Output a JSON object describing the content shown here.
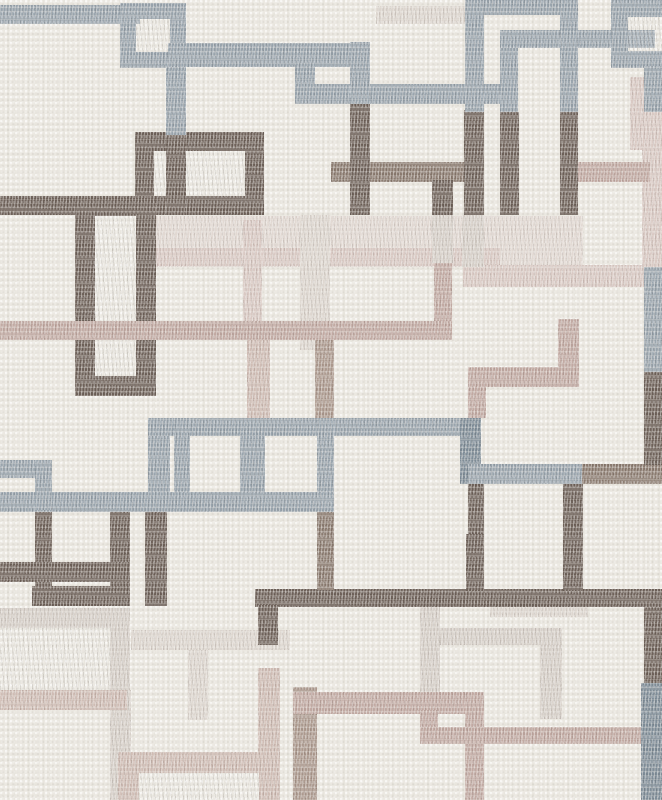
{
  "meta": {
    "kind": "wallpaper-pattern-swatch",
    "description": "Cream woven-texture wallpaper with overlapping stitched square outlines in slate blue-gray, dark brown, taupe, mauve pink and pale greige",
    "width": 662,
    "height": 800
  },
  "palette": {
    "background": "#ebe8e1",
    "slate": "#98a3ac",
    "slate_dark": "#7e8c97",
    "brown": "#6e6159",
    "taupe": "#8a7a6f",
    "taupe_light": "#ab988d",
    "mauve": "#c1a9a2",
    "pink_light": "#cfbcb4",
    "pale_pink": "#d9c9c3",
    "greige": "#d6cfc8",
    "greige_light": "#ddd6cf",
    "wash": "#e1d8d2"
  },
  "shapes": [
    {
      "n": "band-top-left",
      "k": "bar",
      "x": 0,
      "y": 5,
      "w": 140,
      "h": 19,
      "c": "slate",
      "z": 60
    },
    {
      "n": "square-top-left",
      "k": "frame",
      "x": 120,
      "y": 3,
      "w": 66,
      "h": 65,
      "b": 16,
      "c": "slate",
      "z": 60
    },
    {
      "n": "band-y48",
      "k": "bar",
      "x": 168,
      "y": 43,
      "w": 202,
      "h": 24,
      "c": "slate",
      "z": 60
    },
    {
      "n": "vert-x166",
      "k": "bar",
      "x": 166,
      "y": 67,
      "w": 20,
      "h": 68,
      "c": "slate",
      "z": 60
    },
    {
      "n": "vert-x295",
      "k": "bar",
      "x": 295,
      "y": 63,
      "w": 20,
      "h": 41,
      "c": "slate",
      "z": 60
    },
    {
      "n": "band-y84",
      "k": "bar",
      "x": 295,
      "y": 84,
      "w": 207,
      "h": 20,
      "c": "slate",
      "z": 60
    },
    {
      "n": "vert-x350-top",
      "k": "bar",
      "x": 350,
      "y": 42,
      "w": 20,
      "h": 62,
      "c": "slate",
      "z": 60
    },
    {
      "n": "band-top-center",
      "k": "bar",
      "x": 465,
      "y": 0,
      "w": 113,
      "h": 15,
      "c": "slate",
      "z": 60
    },
    {
      "n": "vert-x465-top",
      "k": "bar",
      "x": 465,
      "y": 0,
      "w": 19,
      "h": 112,
      "c": "slate",
      "z": 60
    },
    {
      "n": "band-y30",
      "k": "bar",
      "x": 500,
      "y": 30,
      "w": 155,
      "h": 18,
      "c": "slate",
      "z": 60
    },
    {
      "n": "vert-x500-top",
      "k": "bar",
      "x": 500,
      "y": 48,
      "w": 18,
      "h": 64,
      "c": "slate",
      "z": 60
    },
    {
      "n": "vert-x560-top",
      "k": "bar",
      "x": 560,
      "y": 15,
      "w": 18,
      "h": 97,
      "c": "slate",
      "z": 60
    },
    {
      "n": "square-top-right",
      "k": "frame",
      "x": 611,
      "y": 0,
      "w": 80,
      "h": 68,
      "b": 17,
      "c": "slate",
      "z": 60
    },
    {
      "n": "vert-right-upper",
      "k": "bar",
      "x": 644,
      "y": 66,
      "w": 18,
      "h": 46,
      "c": "slate",
      "z": 60
    },
    {
      "n": "band-y418",
      "k": "bar",
      "x": 148,
      "y": 418,
      "w": 333,
      "h": 18,
      "c": "slate",
      "z": 60
    },
    {
      "n": "vert-x148",
      "k": "bar",
      "x": 148,
      "y": 436,
      "w": 22,
      "h": 76,
      "c": "slate",
      "z": 60
    },
    {
      "n": "vert-x174",
      "k": "bar",
      "x": 174,
      "y": 418,
      "w": 16,
      "h": 75,
      "c": "slate",
      "z": 60
    },
    {
      "n": "vert-x240",
      "k": "bar",
      "x": 240,
      "y": 436,
      "w": 25,
      "h": 57,
      "c": "slate",
      "z": 60
    },
    {
      "n": "vert-x317-slate",
      "k": "bar",
      "x": 317,
      "y": 418,
      "w": 17,
      "h": 75,
      "c": "slate",
      "z": 60
    },
    {
      "n": "band-y493",
      "k": "bar",
      "x": 0,
      "y": 492,
      "w": 334,
      "h": 20,
      "c": "slate",
      "z": 60
    },
    {
      "n": "band-left-y460",
      "k": "bar",
      "x": 0,
      "y": 460,
      "w": 52,
      "h": 18,
      "c": "slate",
      "z": 60
    },
    {
      "n": "vert-x35-slate",
      "k": "bar",
      "x": 35,
      "y": 460,
      "w": 17,
      "h": 50,
      "c": "slate",
      "z": 60
    },
    {
      "n": "vert-x460-dark",
      "k": "bar",
      "x": 460,
      "y": 418,
      "w": 21,
      "h": 66,
      "c": "slate_dark",
      "z": 60
    },
    {
      "n": "band-y464",
      "k": "bar",
      "x": 468,
      "y": 464,
      "w": 114,
      "h": 20,
      "c": "slate",
      "z": 60
    },
    {
      "n": "band-y464-right",
      "k": "bar",
      "x": 582,
      "y": 464,
      "w": 80,
      "h": 20,
      "c": "taupe",
      "z": 45
    },
    {
      "n": "vert-right-mid-slate",
      "k": "bar",
      "x": 644,
      "y": 267,
      "w": 18,
      "h": 105,
      "c": "slate",
      "z": 60
    },
    {
      "n": "vert-right-bottom-slate",
      "k": "bar",
      "x": 641,
      "y": 683,
      "w": 21,
      "h": 117,
      "c": "slate_dark",
      "z": 60
    },
    {
      "n": "frame-b1",
      "k": "frame",
      "x": 135,
      "y": 132,
      "w": 129,
      "h": 83,
      "b": 19,
      "c": "brown",
      "z": 50
    },
    {
      "n": "vert-b1-inner",
      "k": "bar",
      "x": 166,
      "y": 135,
      "w": 20,
      "h": 80,
      "c": "brown",
      "z": 50
    },
    {
      "n": "band-y196-left",
      "k": "bar",
      "x": 0,
      "y": 196,
      "w": 140,
      "h": 19,
      "c": "brown",
      "z": 50
    },
    {
      "n": "frame-tall-left",
      "k": "frame",
      "x": 75,
      "y": 196,
      "w": 81,
      "h": 200,
      "b": 20,
      "c": "brown",
      "z": 50
    },
    {
      "n": "vert-x350-brown",
      "k": "bar",
      "x": 350,
      "y": 104,
      "w": 20,
      "h": 111,
      "c": "brown",
      "z": 50
    },
    {
      "n": "vert-x432-brown",
      "k": "bar",
      "x": 432,
      "y": 180,
      "w": 21,
      "h": 35,
      "c": "brown",
      "z": 50
    },
    {
      "n": "vert-x464-brown",
      "k": "bar",
      "x": 464,
      "y": 110,
      "w": 20,
      "h": 105,
      "c": "brown",
      "z": 50
    },
    {
      "n": "vert-x500-brown",
      "k": "bar",
      "x": 500,
      "y": 112,
      "w": 19,
      "h": 103,
      "c": "brown",
      "z": 50
    },
    {
      "n": "vert-x560-brown",
      "k": "bar",
      "x": 560,
      "y": 112,
      "w": 18,
      "h": 103,
      "c": "brown",
      "z": 50
    },
    {
      "n": "vert-right-brown-mid",
      "k": "bar",
      "x": 644,
      "y": 372,
      "w": 18,
      "h": 93,
      "c": "brown",
      "z": 50
    },
    {
      "n": "vert-x35-brown",
      "k": "bar",
      "x": 35,
      "y": 510,
      "w": 17,
      "h": 96,
      "c": "brown",
      "z": 50
    },
    {
      "n": "vert-x110-brown",
      "k": "bar",
      "x": 110,
      "y": 510,
      "w": 20,
      "h": 96,
      "c": "brown",
      "z": 50
    },
    {
      "n": "band-y562",
      "k": "bar",
      "x": 0,
      "y": 562,
      "w": 130,
      "h": 20,
      "c": "brown",
      "z": 50
    },
    {
      "n": "band-y586",
      "k": "bar",
      "x": 32,
      "y": 586,
      "w": 98,
      "h": 20,
      "c": "brown",
      "z": 50
    },
    {
      "n": "vert-x145-brown",
      "k": "bar",
      "x": 145,
      "y": 510,
      "w": 22,
      "h": 96,
      "c": "brown",
      "z": 50
    },
    {
      "n": "band-y589",
      "k": "bar",
      "x": 255,
      "y": 589,
      "w": 407,
      "h": 18,
      "c": "brown",
      "z": 50
    },
    {
      "n": "vert-x258-brown",
      "k": "bar",
      "x": 258,
      "y": 605,
      "w": 20,
      "h": 40,
      "c": "brown",
      "z": 50
    },
    {
      "n": "vert-x466-brown2",
      "k": "bar",
      "x": 466,
      "y": 534,
      "w": 18,
      "h": 57,
      "c": "brown",
      "z": 50
    },
    {
      "n": "vert-x563-brown2",
      "k": "bar",
      "x": 563,
      "y": 534,
      "w": 20,
      "h": 57,
      "c": "brown",
      "z": 50
    },
    {
      "n": "vert-x317-taupe",
      "k": "bar",
      "x": 317,
      "y": 510,
      "w": 17,
      "h": 80,
      "c": "taupe",
      "z": 50
    },
    {
      "n": "vert-right-brown-low",
      "k": "bar",
      "x": 644,
      "y": 607,
      "w": 18,
      "h": 76,
      "c": "brown",
      "z": 50
    },
    {
      "n": "vert-x468-brown3",
      "k": "bar",
      "x": 468,
      "y": 484,
      "w": 16,
      "h": 50,
      "c": "brown",
      "z": 50
    },
    {
      "n": "vert-x563-brown3",
      "k": "bar",
      "x": 563,
      "y": 484,
      "w": 20,
      "h": 50,
      "c": "brown",
      "z": 50
    },
    {
      "n": "band-y162",
      "k": "bar",
      "x": 331,
      "y": 162,
      "w": 135,
      "h": 20,
      "c": "taupe",
      "z": 45
    },
    {
      "n": "band-y162-right",
      "k": "bar",
      "x": 578,
      "y": 162,
      "w": 72,
      "h": 20,
      "c": "mauve",
      "z": 45
    },
    {
      "n": "band-pink-y321",
      "k": "bar",
      "x": 0,
      "y": 321,
      "w": 452,
      "h": 19,
      "c": "mauve",
      "z": 55
    },
    {
      "n": "vert-x434-mauve",
      "k": "bar",
      "x": 434,
      "y": 263,
      "w": 18,
      "h": 58,
      "c": "mauve",
      "z": 40
    },
    {
      "n": "vert-x432-greige",
      "k": "bar",
      "x": 432,
      "y": 215,
      "w": 21,
      "h": 48,
      "c": "greige",
      "z": 20
    },
    {
      "n": "vert-x462-greige",
      "k": "bar",
      "x": 462,
      "y": 215,
      "w": 22,
      "h": 52,
      "c": "greige",
      "z": 20
    },
    {
      "n": "vert-x558-mauve",
      "k": "bar",
      "x": 558,
      "y": 319,
      "w": 21,
      "h": 51,
      "c": "mauve",
      "z": 40
    },
    {
      "n": "band-y367",
      "k": "bar",
      "x": 468,
      "y": 367,
      "w": 111,
      "h": 20,
      "c": "mauve",
      "z": 40
    },
    {
      "n": "vert-x468-mauve",
      "k": "bar",
      "x": 468,
      "y": 387,
      "w": 18,
      "h": 31,
      "c": "mauve",
      "z": 40
    },
    {
      "n": "vert-x247-pink",
      "k": "bar",
      "x": 247,
      "y": 339,
      "w": 23,
      "h": 79,
      "c": "pink_light",
      "z": 40
    },
    {
      "n": "vert-x315-taupe2",
      "k": "bar",
      "x": 315,
      "y": 339,
      "w": 19,
      "h": 79,
      "c": "taupe_light",
      "z": 40
    },
    {
      "n": "vert-x243-palepink",
      "k": "bar",
      "x": 243,
      "y": 220,
      "w": 19,
      "h": 119,
      "c": "pale_pink",
      "z": 19
    },
    {
      "n": "vert-x300-greige",
      "k": "bar",
      "x": 300,
      "y": 215,
      "w": 30,
      "h": 135,
      "c": "greige_light",
      "z": 19
    },
    {
      "n": "band-y692",
      "k": "bar",
      "x": 293,
      "y": 692,
      "w": 191,
      "h": 22,
      "c": "mauve",
      "z": 40
    },
    {
      "n": "band-y690-left",
      "k": "bar",
      "x": 0,
      "y": 690,
      "w": 127,
      "h": 20,
      "c": "pink_light",
      "z": 40
    },
    {
      "n": "vert-x465-mauve2",
      "k": "bar",
      "x": 465,
      "y": 692,
      "w": 19,
      "h": 108,
      "c": "mauve",
      "z": 40
    },
    {
      "n": "vert-x420-mauve",
      "k": "bar",
      "x": 420,
      "y": 710,
      "w": 18,
      "h": 34,
      "c": "mauve",
      "z": 40
    },
    {
      "n": "band-y727",
      "k": "bar",
      "x": 420,
      "y": 727,
      "w": 223,
      "h": 17,
      "c": "mauve",
      "z": 40
    },
    {
      "n": "vert-x293-taupe",
      "k": "bar",
      "x": 293,
      "y": 687,
      "w": 24,
      "h": 113,
      "c": "taupe_light",
      "z": 38
    },
    {
      "n": "vert-x258-pink",
      "k": "bar",
      "x": 258,
      "y": 668,
      "w": 22,
      "h": 84,
      "c": "pink_light",
      "z": 38
    },
    {
      "n": "frame-bottom-pink",
      "k": "frame",
      "x": 118,
      "y": 752,
      "w": 162,
      "h": 78,
      "b": 21,
      "c": "pink_light",
      "z": 40
    },
    {
      "n": "right-palepink-upper",
      "k": "bar",
      "x": 630,
      "y": 77,
      "w": 32,
      "h": 73,
      "c": "pale_pink",
      "z": 30
    },
    {
      "n": "right-pink-col",
      "k": "bar",
      "x": 642,
      "y": 112,
      "w": 20,
      "h": 155,
      "c": "pale_pink",
      "z": 30
    },
    {
      "n": "band-y265-palepink",
      "k": "bar",
      "x": 463,
      "y": 265,
      "w": 185,
      "h": 22,
      "c": "pale_pink",
      "z": 18
    },
    {
      "n": "wash-mid",
      "k": "bar",
      "x": 137,
      "y": 216,
      "w": 446,
      "h": 51,
      "c": "wash",
      "z": 15
    },
    {
      "n": "wash-pink-strip",
      "k": "bar",
      "x": 137,
      "y": 248,
      "w": 363,
      "h": 18,
      "c": "pale_pink",
      "z": 16
    },
    {
      "n": "frame-pale-left",
      "k": "frame",
      "x": -50,
      "y": 608,
      "w": 180,
      "h": 102,
      "b": 20,
      "c": "greige",
      "z": 20
    },
    {
      "n": "vert-x110-greige",
      "k": "bar",
      "x": 110,
      "y": 690,
      "w": 21,
      "h": 110,
      "c": "greige",
      "z": 20
    },
    {
      "n": "band-y630-greige",
      "k": "bar",
      "x": 131,
      "y": 630,
      "w": 159,
      "h": 20,
      "c": "greige_light",
      "z": 20
    },
    {
      "n": "vert-x188-greige",
      "k": "bar",
      "x": 188,
      "y": 650,
      "w": 20,
      "h": 70,
      "c": "greige_light",
      "z": 20
    },
    {
      "n": "vert-x420-greige",
      "k": "bar",
      "x": 420,
      "y": 607,
      "w": 20,
      "h": 85,
      "c": "greige",
      "z": 20
    },
    {
      "n": "band-y628-greige",
      "k": "bar",
      "x": 440,
      "y": 628,
      "w": 122,
      "h": 17,
      "c": "greige",
      "z": 20
    },
    {
      "n": "vert-x540-greige",
      "k": "bar",
      "x": 540,
      "y": 645,
      "w": 22,
      "h": 74,
      "c": "greige",
      "z": 20
    },
    {
      "n": "band-y605-greige",
      "k": "bar",
      "x": 490,
      "y": 605,
      "w": 98,
      "h": 12,
      "c": "greige_light",
      "z": 20
    },
    {
      "n": "band-top-greige",
      "k": "bar",
      "x": 376,
      "y": 6,
      "w": 89,
      "h": 18,
      "c": "greige_light",
      "z": 20
    }
  ]
}
